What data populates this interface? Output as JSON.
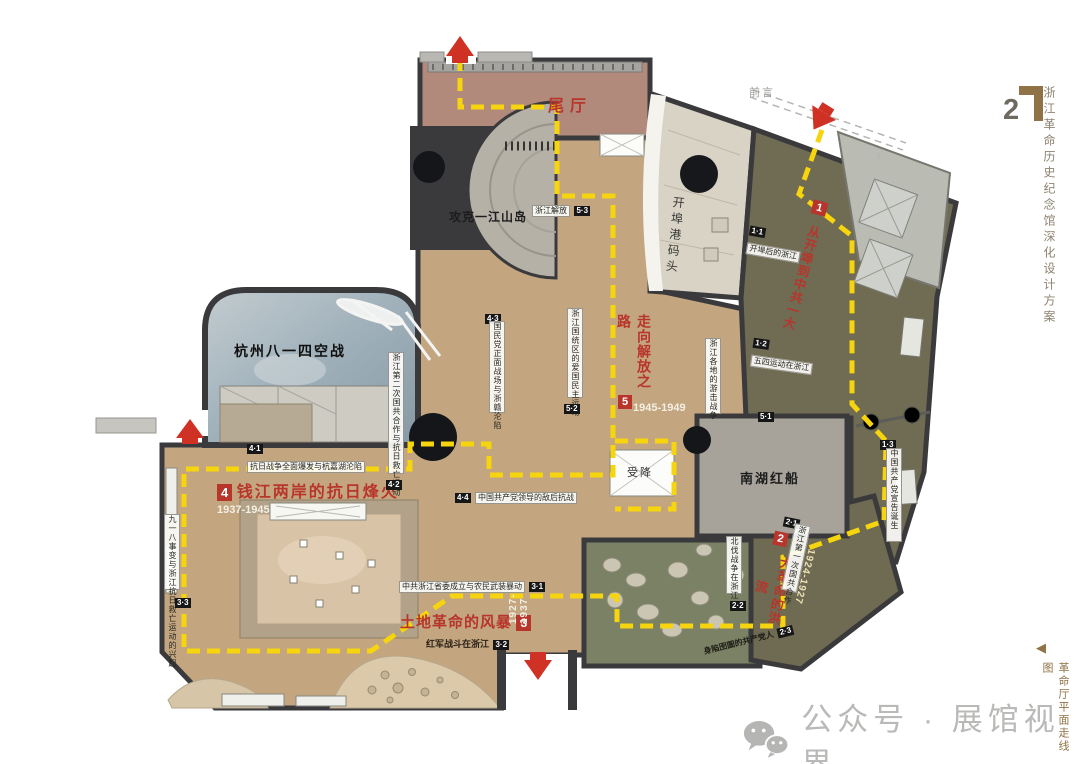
{
  "sidebar": {
    "page_number": "2",
    "project_title": "浙江革命历史纪念馆深化设计方案",
    "drawing_marker": "◀",
    "drawing_title": "革命厅平面走线图"
  },
  "watermark": {
    "icon": "wechat-icon",
    "text": "公众号 · 展馆视界"
  },
  "plan": {
    "entry_label": "前言",
    "halls": {
      "end_hall": "尾厅",
      "yijiangshan": "攻克一江山岛",
      "wharf": "开埠港码头",
      "air_battle": "杭州八一四空战",
      "surrender": "受降",
      "red_boat": "南湖红船"
    },
    "sections": [
      {
        "num": "1",
        "title": "从开埠到中共一大",
        "years": "",
        "subs": [
          {
            "code": "1·1",
            "label": "开埠后的浙江"
          },
          {
            "code": "1·2",
            "label": "五四运动在浙江"
          },
          {
            "code": "1·3",
            "label": "中国共产党宣告诞生"
          }
        ]
      },
      {
        "num": "2",
        "title": "大革命的洪流",
        "years": "1924-1927",
        "subs": [
          {
            "code": "2·1",
            "label": "浙江第一次国共合作"
          },
          {
            "code": "2·2",
            "label": "北伐战争在浙江"
          },
          {
            "code": "2·3",
            "label": "身陷囹圄的共产党人"
          }
        ]
      },
      {
        "num": "3",
        "title": "土地革命的风暴",
        "years": "1927-1937",
        "subs": [
          {
            "code": "3·1",
            "label": "中共浙江省委成立与农民武装暴动"
          },
          {
            "code": "3·2",
            "label": "红军战斗在浙江"
          },
          {
            "code": "3·3",
            "label": "九一八事变与浙江抗日救亡运动的兴起"
          }
        ]
      },
      {
        "num": "4",
        "title": "钱江两岸的抗日烽火",
        "years": "1937-1945",
        "subs": [
          {
            "code": "4·1",
            "label": "抗日战争全面爆发与杭嘉湖沦陷"
          },
          {
            "code": "4·2",
            "label": "浙江第二次国共合作与抗日救亡运动"
          },
          {
            "code": "4·3",
            "label": "国民党正面战场与浙赣沦陷"
          },
          {
            "code": "4·4",
            "label": "中国共产党领导的敌后抗战"
          }
        ]
      },
      {
        "num": "5",
        "title": "走向解放之路",
        "years": "1945-1949",
        "subs": [
          {
            "code": "5·1",
            "label": "浙江各地的游击战争"
          },
          {
            "code": "5·2",
            "label": "浙江国统区的爱国民主运动"
          },
          {
            "code": "5·3",
            "label": "浙江解放"
          }
        ]
      }
    ]
  },
  "colors": {
    "route_yellow": "#f6d40e",
    "accent_red": "#c0392f",
    "wall_dark": "#3a3a3c",
    "floor_tan": "#c3a67f",
    "floor_mauve": "#b28a7c",
    "floor_olive": "#706b53",
    "floor_green": "#7b8165",
    "floor_gray": "#a7a39a"
  }
}
